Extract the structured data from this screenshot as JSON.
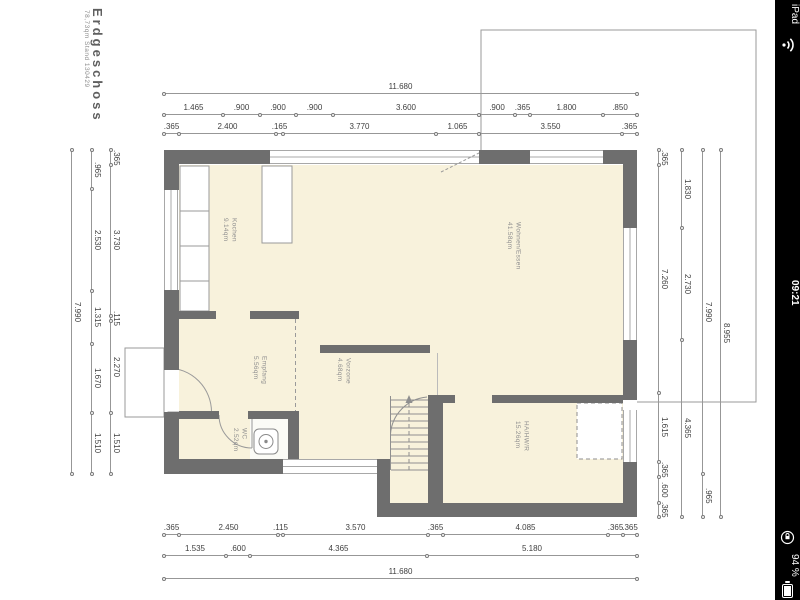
{
  "status_bar": {
    "device_label": "iPad",
    "time": "09:21",
    "battery_percent": "94 %",
    "icons": [
      "wifi-icon",
      "rotation-lock-icon",
      "battery-icon"
    ]
  },
  "title_block": {
    "title": "Erdgeschoss",
    "subtitle": "78,73qm Stand 130429"
  },
  "rooms": [
    {
      "name": "Kochen",
      "area": "9.14qm",
      "x": 221,
      "y": 218
    },
    {
      "name": "Wohnen/Essen",
      "area": "41.58qm",
      "x": 505,
      "y": 222
    },
    {
      "name": "Empfang",
      "area": "5.56qm",
      "x": 251,
      "y": 356
    },
    {
      "name": "Vorzone",
      "area": "4.68qm",
      "x": 335,
      "y": 358
    },
    {
      "name": "WC",
      "area": "2.52qm",
      "x": 231,
      "y": 428
    },
    {
      "name": "HA/HW/R",
      "area": "15.26qm",
      "x": 513,
      "y": 421
    }
  ],
  "dimension_chains": [
    {
      "id": "top-total",
      "axis": "h",
      "pos": 93,
      "start": 164,
      "segments": [
        {
          "label": "11.680",
          "len": 473
        }
      ]
    },
    {
      "id": "top-windows",
      "axis": "h",
      "pos": 114,
      "start": 164,
      "segments": [
        {
          "label": "1.465",
          "len": 59
        },
        {
          "label": ".900",
          "len": 37
        },
        {
          "label": ".900",
          "len": 36
        },
        {
          "label": ".900",
          "len": 37
        },
        {
          "label": "3.600",
          "len": 146
        },
        {
          "label": ".900",
          "len": 36
        },
        {
          "label": ".365",
          "len": 15
        },
        {
          "label": "1.800",
          "len": 73
        },
        {
          "label": ".850",
          "len": 34
        }
      ]
    },
    {
      "id": "top-walls",
      "axis": "h",
      "pos": 133,
      "start": 164,
      "segments": [
        {
          "label": ".365",
          "len": 15
        },
        {
          "label": "2.400",
          "len": 97
        },
        {
          "label": ".165",
          "len": 7
        },
        {
          "label": "3.770",
          "len": 153
        },
        {
          "label": "1.065",
          "len": 43
        },
        {
          "label": "3.550",
          "len": 143
        },
        {
          "label": ".365",
          "len": 15
        }
      ]
    },
    {
      "id": "bottom-walls",
      "axis": "h",
      "pos": 534,
      "start": 164,
      "segments": [
        {
          "label": ".365",
          "len": 15
        },
        {
          "label": "2.450",
          "len": 99
        },
        {
          "label": ".115",
          "len": 5
        },
        {
          "label": "3.570",
          "len": 145
        },
        {
          "label": ".365",
          "len": 15
        },
        {
          "label": "4.085",
          "len": 165
        },
        {
          "label": ".365",
          "len": 15
        },
        {
          "label": ".365",
          "len": 14
        }
      ]
    },
    {
      "id": "bottom-rooms",
      "axis": "h",
      "pos": 555,
      "start": 164,
      "segments": [
        {
          "label": "1.535",
          "len": 62
        },
        {
          "label": ".600",
          "len": 24
        },
        {
          "label": "4.365",
          "len": 177
        },
        {
          "label": "5.180",
          "len": 210
        }
      ]
    },
    {
      "id": "bottom-total",
      "axis": "h",
      "pos": 578,
      "start": 164,
      "segments": [
        {
          "label": "11.680",
          "len": 473
        }
      ]
    },
    {
      "id": "left-inner",
      "axis": "v",
      "pos": 110,
      "start": 150,
      "segments": [
        {
          "label": ".365",
          "len": 15
        },
        {
          "label": "3.730",
          "len": 151
        },
        {
          "label": ".115",
          "len": 5
        },
        {
          "label": "2.270",
          "len": 92
        },
        {
          "label": "1.510",
          "len": 61
        }
      ]
    },
    {
      "id": "left-mid",
      "axis": "v",
      "pos": 91,
      "start": 150,
      "segments": [
        {
          "label": ".965",
          "len": 39
        },
        {
          "label": "2.530",
          "len": 102
        },
        {
          "label": "1.315",
          "len": 53
        },
        {
          "label": "1.670",
          "len": 69
        },
        {
          "label": "1.510",
          "len": 61
        }
      ]
    },
    {
      "id": "left-total",
      "axis": "v",
      "pos": 71,
      "start": 150,
      "segments": [
        {
          "label": "7.990",
          "len": 324
        }
      ]
    },
    {
      "id": "right-1",
      "axis": "v",
      "pos": 658,
      "start": 150,
      "segments": [
        {
          "label": ".365",
          "len": 15
        },
        {
          "label": "7.260",
          "len": 228
        },
        {
          "label": "1.615",
          "len": 69
        },
        {
          "label": ".365",
          "len": 15
        },
        {
          "label": ".600",
          "len": 26
        },
        {
          "label": ".365",
          "len": 14
        }
      ]
    },
    {
      "id": "right-2",
      "axis": "v",
      "pos": 681,
      "start": 150,
      "segments": [
        {
          "label": "1.830",
          "len": 78
        },
        {
          "label": "2.730",
          "len": 112
        },
        {
          "label": "4.365",
          "len": 177
        }
      ]
    },
    {
      "id": "right-3",
      "axis": "v",
      "pos": 702,
      "start": 150,
      "segments": [
        {
          "label": "7.990",
          "len": 324
        },
        {
          "label": ".965",
          "len": 43
        }
      ]
    },
    {
      "id": "right-4",
      "axis": "v",
      "pos": 720,
      "start": 150,
      "segments": [
        {
          "label": "8.955",
          "len": 367
        }
      ]
    }
  ],
  "colors": {
    "wall": "#6e6e6e",
    "room_fill": "#f8f2dc",
    "dim_line": "#979797",
    "dim_text": "#3f3f3f",
    "statusbar_bg": "#000000",
    "statusbar_fg": "#ffffff"
  }
}
